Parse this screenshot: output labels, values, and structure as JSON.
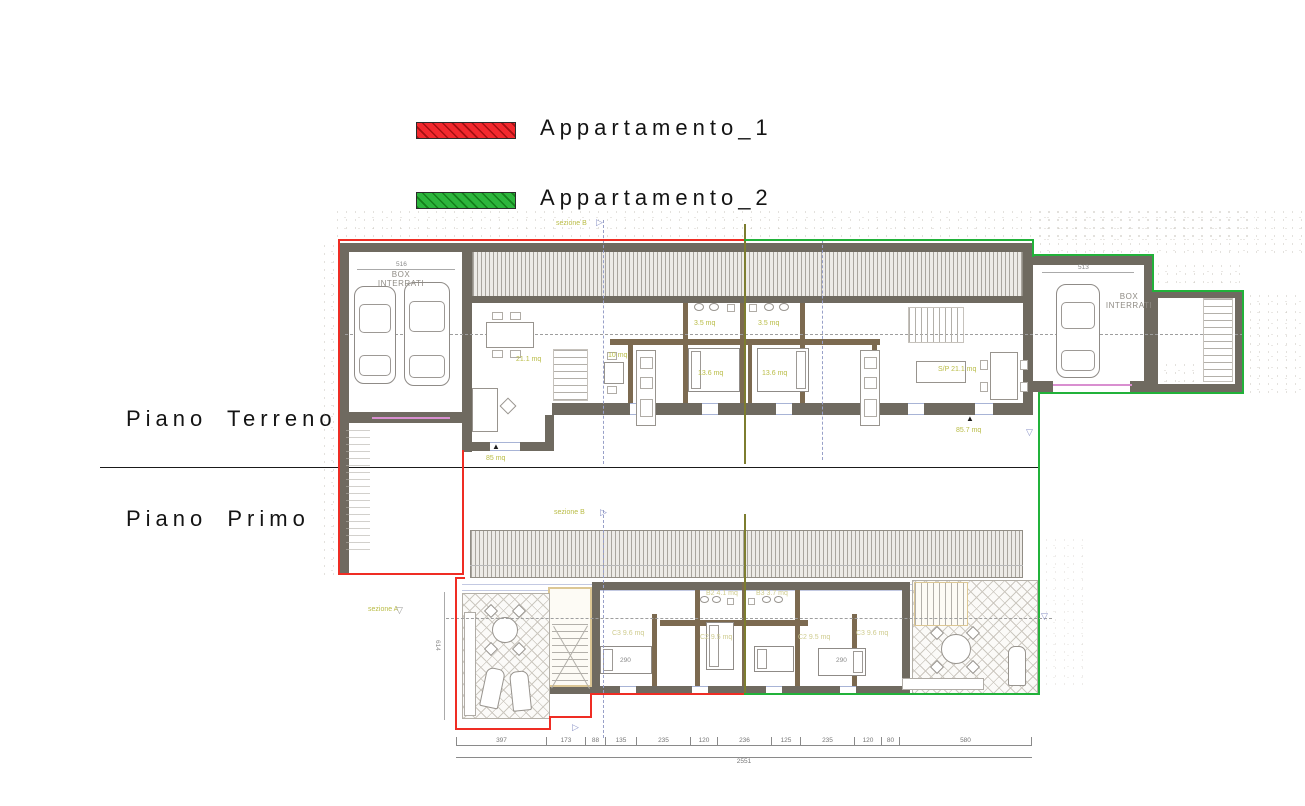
{
  "legend": {
    "items": [
      {
        "label": "Appartamento_1",
        "color": "#f2282d"
      },
      {
        "label": "Appartamento_2",
        "color": "#2cb53c"
      }
    ]
  },
  "floors": {
    "ground": "Piano Terreno",
    "first": "Piano Primo"
  },
  "ground_floor": {
    "garage_left": {
      "line1": "BOX",
      "line2": "INTERRATI",
      "width_dim": "516"
    },
    "garage_right": {
      "line1": "BOX",
      "line2": "INTERRATI",
      "width_dim": "513"
    },
    "section_label": "sezione B",
    "areas": {
      "apartment1_total": "85 mq",
      "apartment2_total": "85.7 mq",
      "living_left": "21.1 mq",
      "kitchen_left": "10 mq",
      "bath_left": "3.5 mq",
      "bath_right": "3.5 mq",
      "bed_left": "13.6 mq",
      "bed_right": "13.6 mq",
      "living_right": "S/P 21.1 mq"
    }
  },
  "first_floor": {
    "section_label": "sezione B",
    "section_a_label": "sezione A",
    "rooms": {
      "bed1": "C3 9.6 mq",
      "bed2": "C2 9.5 mq",
      "bed3": "C2 9.5 mq",
      "bed4": "C3 9.6 mq",
      "bath1": "B2 4.1 mq",
      "bath2": "B3 3.7 mq"
    },
    "dims": {
      "segments": [
        "397",
        "173",
        "88",
        "135",
        "235",
        "120",
        "236",
        "125",
        "235",
        "120",
        "80",
        "580"
      ],
      "total": "2551",
      "side": "614",
      "bed_width_left": "290",
      "bed_width_right": "290"
    }
  }
}
